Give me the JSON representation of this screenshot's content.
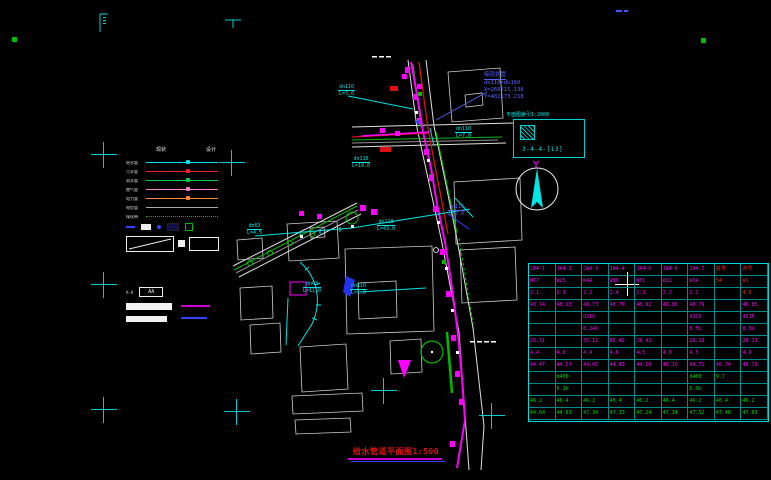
{
  "window": {
    "width": 771,
    "height": 480,
    "background": "#000000"
  },
  "title_block": {
    "text": "给水管道平面图1:500"
  },
  "callout": {
    "line1": "接现状管",
    "line2": "dn110×dn160",
    "line3": "X=266215.138",
    "line4": "Y=482173.218"
  },
  "detail_index": {
    "caption": "平面图索引1:2000",
    "label": "3-4-4-[13]"
  },
  "legend": {
    "headers": [
      "现状",
      "设计"
    ],
    "items": [
      {
        "label": "给水管",
        "color": "#00e5ff",
        "style": "solid",
        "marker": true
      },
      {
        "label": "污水管",
        "color": "#ee2222",
        "style": "solid",
        "marker": true
      },
      {
        "label": "雨水管",
        "color": "#00cc44",
        "style": "solid",
        "marker": true
      },
      {
        "label": "燃气管",
        "color": "#ff7fd4",
        "style": "solid",
        "marker": true
      },
      {
        "label": "电力管",
        "color": "#ff8833",
        "style": "solid",
        "marker": true
      },
      {
        "label": "电信管",
        "color": "#aaaaaa",
        "style": "solid",
        "marker": false
      },
      {
        "label": "绿化带",
        "color": "#00bb00",
        "style": "dotted",
        "marker": false
      }
    ],
    "box_label": "AA"
  },
  "pipe_labels": [
    {
      "text": "dn110",
      "sub": "L=3.0",
      "x": 338,
      "y": 84,
      "color": "#00e5e5"
    },
    {
      "text": "dn110",
      "sub": "L=7.0",
      "x": 455,
      "y": 126,
      "color": "#00e5e5"
    },
    {
      "text": "dn110",
      "sub": "L=19.0",
      "x": 352,
      "y": 156,
      "color": "#00e5e5"
    },
    {
      "text": "dn110",
      "sub": "L=43.0",
      "x": 377,
      "y": 219,
      "color": "#00e5e5"
    },
    {
      "text": "dn63",
      "sub": "L=4.5",
      "x": 247,
      "y": 223,
      "color": "#00e5e5"
    },
    {
      "text": "dn63",
      "sub": "L=11.0",
      "x": 303,
      "y": 281,
      "color": "#00e5e5"
    },
    {
      "text": "dn110",
      "sub": "L=5.0",
      "x": 350,
      "y": 283,
      "color": "#00e5e5"
    },
    {
      "text": "dn110",
      "sub": "L=7.0",
      "x": 448,
      "y": 204,
      "color": "#5566ff"
    }
  ],
  "marks": {
    "crosses": [
      [
        104,
        155
      ],
      [
        104,
        285
      ],
      [
        104,
        410
      ],
      [
        232,
        163
      ],
      [
        384,
        391
      ],
      [
        492,
        416
      ],
      [
        237,
        412
      ]
    ]
  },
  "table": {
    "grid_color": "#00dada",
    "text_colors": {
      "m": "#ff00ff",
      "r": "#ff2222",
      "g": "#00dd00"
    },
    "rows": [
      {
        "color": "m",
        "cells": [
          "JA4-1",
          "JA4-2",
          "JA4-3",
          "JA4-4",
          "JA4-5",
          "JA4-6",
          "JA4-7",
          "桩号",
          "井号"
        ]
      },
      {
        "color": "m",
        "cells": [
          "W77",
          "W25",
          "W42",
          "W19",
          "W31",
          "W12",
          "W14",
          "54",
          "W1"
        ]
      },
      {
        "color": "m",
        "cells": [
          "2.1",
          "2.3",
          "2.2",
          "2.4",
          "2.3",
          "2.2",
          "2.1",
          "",
          "4.6"
        ]
      },
      {
        "color": "m",
        "cells": [
          "48.74",
          "48.93",
          "48.73",
          "48.79",
          "48.92",
          "48.86",
          "48.79",
          "",
          "48.85"
        ]
      },
      {
        "color": "m",
        "cells": [
          "",
          "",
          "d315",
          "",
          "",
          "",
          "d315",
          "",
          "d315"
        ]
      },
      {
        "color": "m",
        "cells": [
          "",
          "",
          "8.24‰",
          "",
          "",
          "",
          "8.5‰",
          "",
          "8.5‰"
        ]
      },
      {
        "color": "m",
        "cells": [
          "28.31",
          "",
          "35.12",
          "85.42",
          "28.42",
          "",
          "26.13",
          "",
          "28.13"
        ]
      },
      {
        "color": "m",
        "cells": [
          "4.4",
          "4.6",
          "4.4",
          "4.6",
          "4.5",
          "4.6",
          "4.5",
          "",
          "4.6"
        ]
      },
      {
        "color": "m",
        "cells": [
          "44.47",
          "44.57",
          "44.07",
          "44.43",
          "44.10",
          "48.10",
          "48.71",
          "48.74",
          "48.79"
        ]
      },
      {
        "color": "g",
        "cells": [
          "",
          "d400",
          "",
          "",
          "",
          "",
          "d400",
          "9.7",
          ""
        ]
      },
      {
        "color": "g",
        "cells": [
          "",
          "5.2‰",
          "",
          "",
          "",
          "",
          "5.0‰",
          "",
          ""
        ]
      },
      {
        "color": "g",
        "cells": [
          "46.2",
          "46.4",
          "46.2",
          "46.4",
          "46.2",
          "46.4",
          "46.2",
          "46.4",
          "46.2"
        ]
      },
      {
        "color": "g",
        "cells": [
          "44.64",
          "44.63",
          "47.34",
          "47.33",
          "47.24",
          "47.34",
          "47.52",
          "47.48",
          "47.63"
        ]
      }
    ],
    "red_cells": [
      [
        0,
        7
      ],
      [
        0,
        8
      ],
      [
        1,
        7
      ],
      [
        1,
        8
      ],
      [
        2,
        7
      ],
      [
        2,
        8
      ],
      [
        3,
        7
      ]
    ]
  }
}
